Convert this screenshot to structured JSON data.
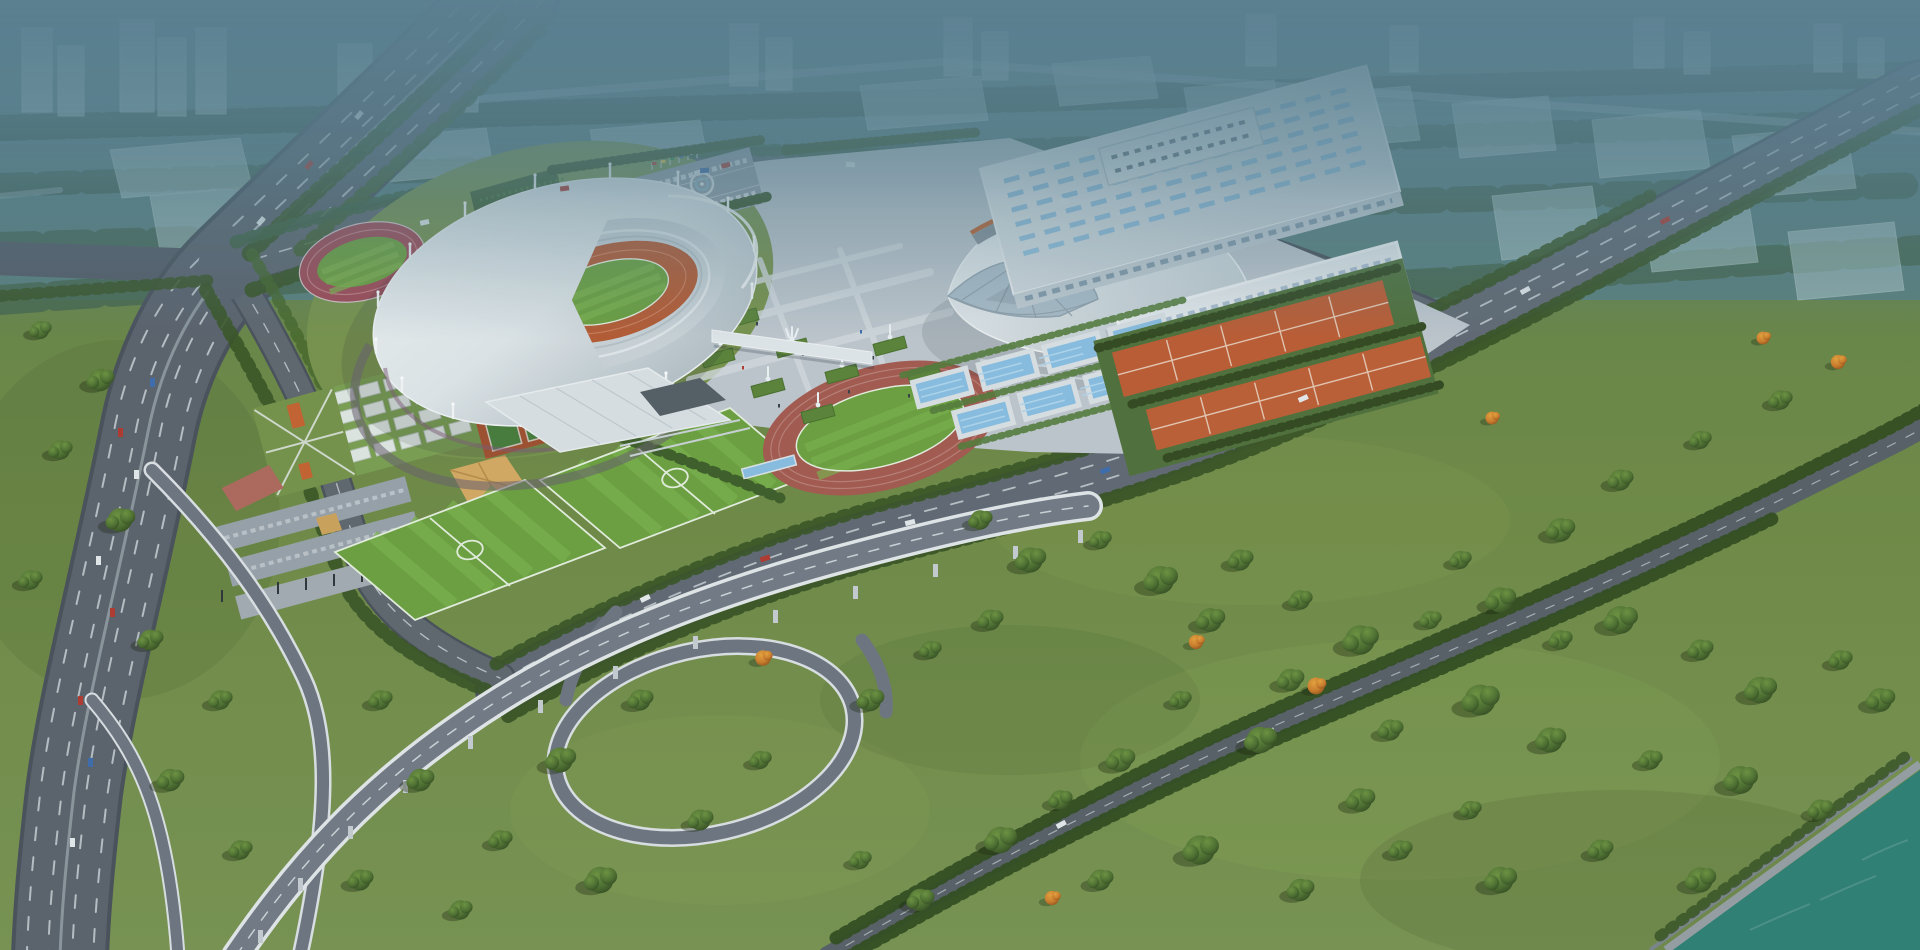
{
  "scene": {
    "title": "Aerial rendering of a riverside sports complex",
    "landmarks": [
      {
        "name": "main-stadium",
        "desc": "oval stadium, white cable-mast ring roof, crescent opening, orange track, green pitch"
      },
      {
        "name": "practice-track",
        "desc": "small maroon training track with green infield, north-west of stadium"
      },
      {
        "name": "gymnasium",
        "desc": "curved shell roof arena with orange arc stripe and arched lattice gable"
      },
      {
        "name": "training-hall-a",
        "desc": "long white exhibition hall with skylight strips"
      },
      {
        "name": "training-hall-b",
        "desc": "white hall with dense square skylight grid"
      },
      {
        "name": "outdoor-pools",
        "desc": "stepped row of eight blue swimming pools"
      },
      {
        "name": "tennis-complex",
        "desc": "two bands of orange tennis courts between tree rows"
      },
      {
        "name": "soccer-pitches",
        "desc": "two striped training soccer pitches"
      },
      {
        "name": "athletics-track-oval",
        "desc": "red running track oval with soccer field inside"
      },
      {
        "name": "central-plaza",
        "desc": "paved plaza with diamond planters and fountains"
      },
      {
        "name": "parking-lot",
        "desc": "tree-lined parking with emblem circle and flag row"
      },
      {
        "name": "highway-interchange",
        "desc": "elevated viaduct, loop ramp and multi-lane highway"
      },
      {
        "name": "riverside-park",
        "desc": "large lawn with scattered trees, a few autumn-orange"
      },
      {
        "name": "river",
        "desc": "teal river in lower-right corner with embankment"
      },
      {
        "name": "background-city",
        "desc": "hazy blue translucent city blocks at the horizon"
      }
    ]
  },
  "colors": {
    "water": "#2f8175",
    "track": "#b85b33",
    "practice_track": "#a34a55",
    "oval_track": "#a65a50",
    "pitch": "#6da23f",
    "pitch_stripe": "#7cb24c",
    "pitch_line": "#e9f2e2",
    "tennis": "#bf5c33",
    "tennis2": "#c05f35",
    "pool": "#8cc0e4",
    "road": "#5c636d",
    "road_line": "#ccd2d7",
    "viaduct": "#737b86",
    "plaza": "#c2c9d0",
    "roof": "#e8ecef",
    "gym_stripe": "#c2622f",
    "hedge": "#3f5f2a",
    "gold": "#d7ab63",
    "pink": "#b26a5e",
    "autumn": "#cf7d2a",
    "car_red": "#b5392f",
    "car_blue": "#3f6cae",
    "car_white": "#e8ecee",
    "pier": "#c9cfd4"
  }
}
